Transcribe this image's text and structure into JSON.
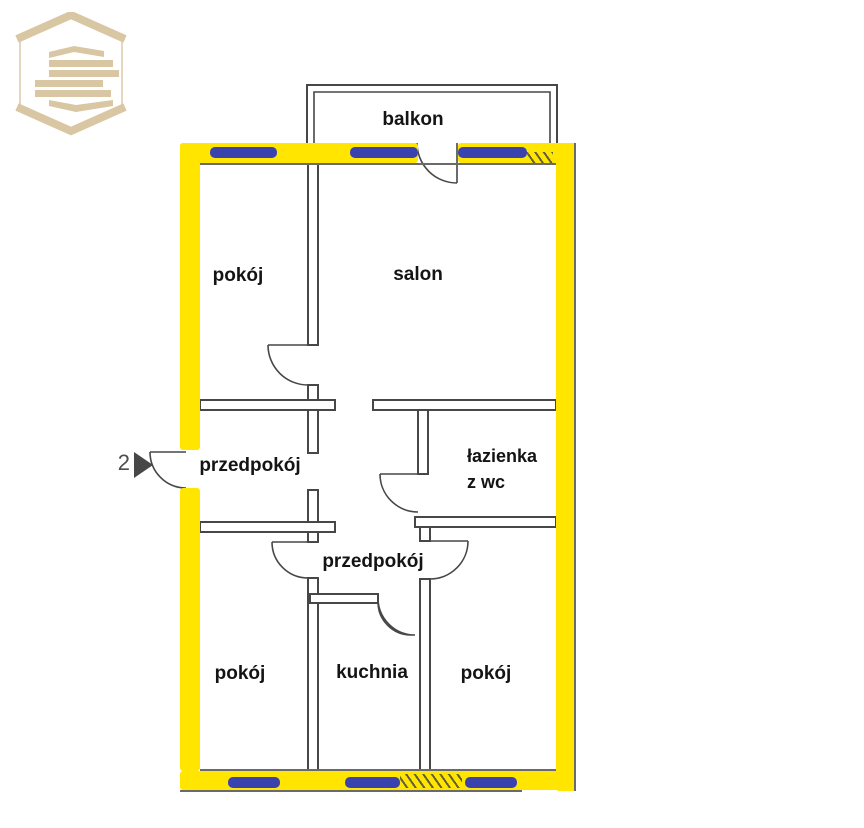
{
  "colors": {
    "wall_yellow": "#FFE500",
    "window_blue": "#3A42AE",
    "wall_line": "#474747",
    "scan_line": "#6a6a6a",
    "logo_tan": "#D9C6A2",
    "text": "#141414",
    "muted": "#4d4d4d"
  },
  "entrance": {
    "number": "2"
  },
  "rooms": {
    "balcony": "balkon",
    "room_top_left": "pokój",
    "living_room": "salon",
    "hallway_upper": "przedpokój",
    "bathroom_line1": "łazienka",
    "bathroom_line2": "z wc",
    "hallway_lower": "przedpokój",
    "room_bottom_left": "pokój",
    "kitchen": "kuchnia",
    "room_bottom_right": "pokój"
  }
}
